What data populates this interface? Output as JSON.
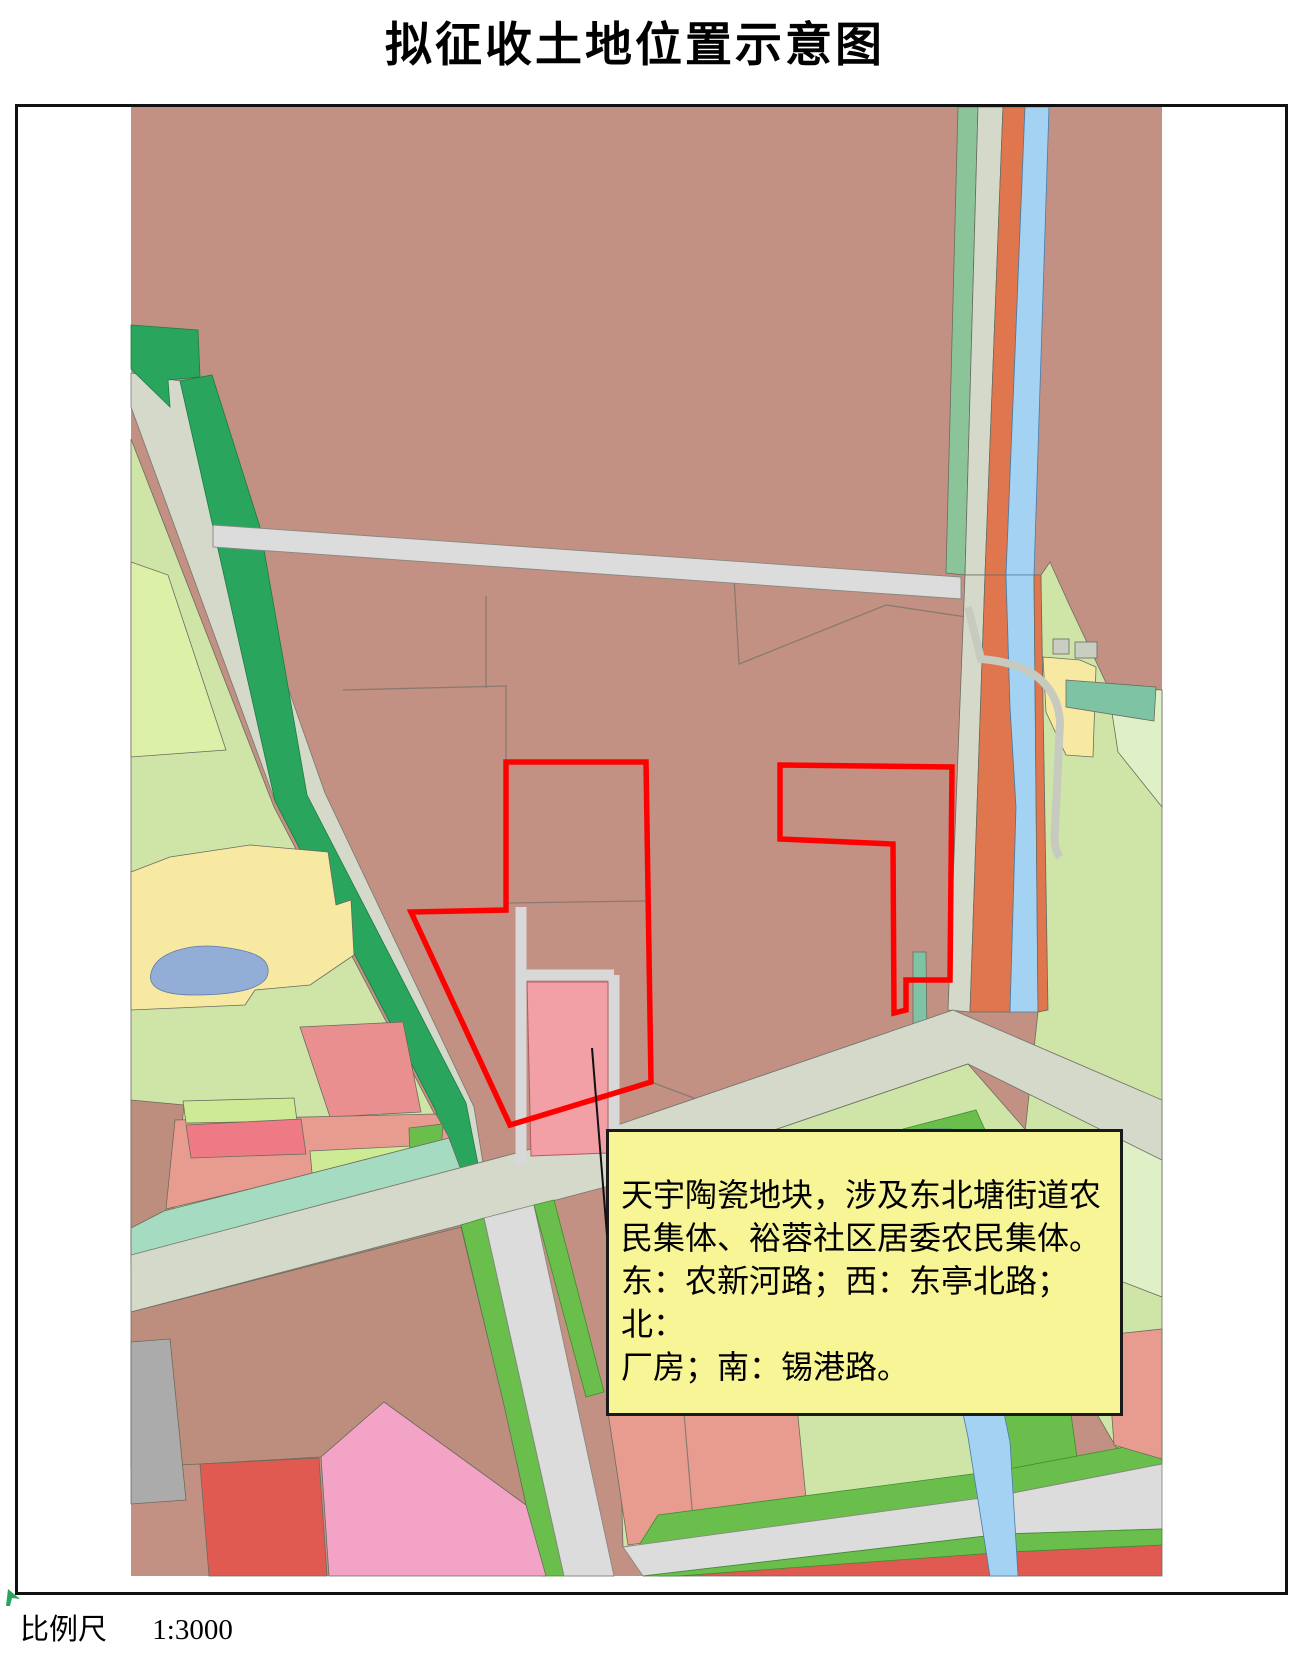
{
  "page": {
    "title": "拟征收土地位置示意图"
  },
  "annotation": {
    "text": "天宇陶瓷地块，涉及东北塘街道农\n民集体、裕蓉社区居委农民集体。\n东：农新河路；西：东亭北路；北：\n厂房；南：锡港路。"
  },
  "scale": {
    "label": "比例尺",
    "value": "1:3000"
  },
  "colors": {
    "acquisition_boundary": "#ff0000",
    "annotation_fill": "#f7f595",
    "parcel_mauve": "#c29184",
    "parcel_brown": "#bd8e7e",
    "parcel_salmon": "#e89c90",
    "parcel_pink": "#f2a0a6",
    "parcel_bright_pink": "#f3a3c6",
    "parcel_red": "#e05a52",
    "parcel_light_green": "#cfe5a8",
    "parcel_mid_green": "#6abf4c",
    "greenbelt_dark": "#2aa55e",
    "parcel_teal": "#7ec4a4",
    "parcel_yellow": "#f8e9a2",
    "river_blue": "#a3d2f2",
    "pond_blue": "#93aed6",
    "road_gray": "#d5d9ca",
    "road_orange": "#e0764e"
  }
}
